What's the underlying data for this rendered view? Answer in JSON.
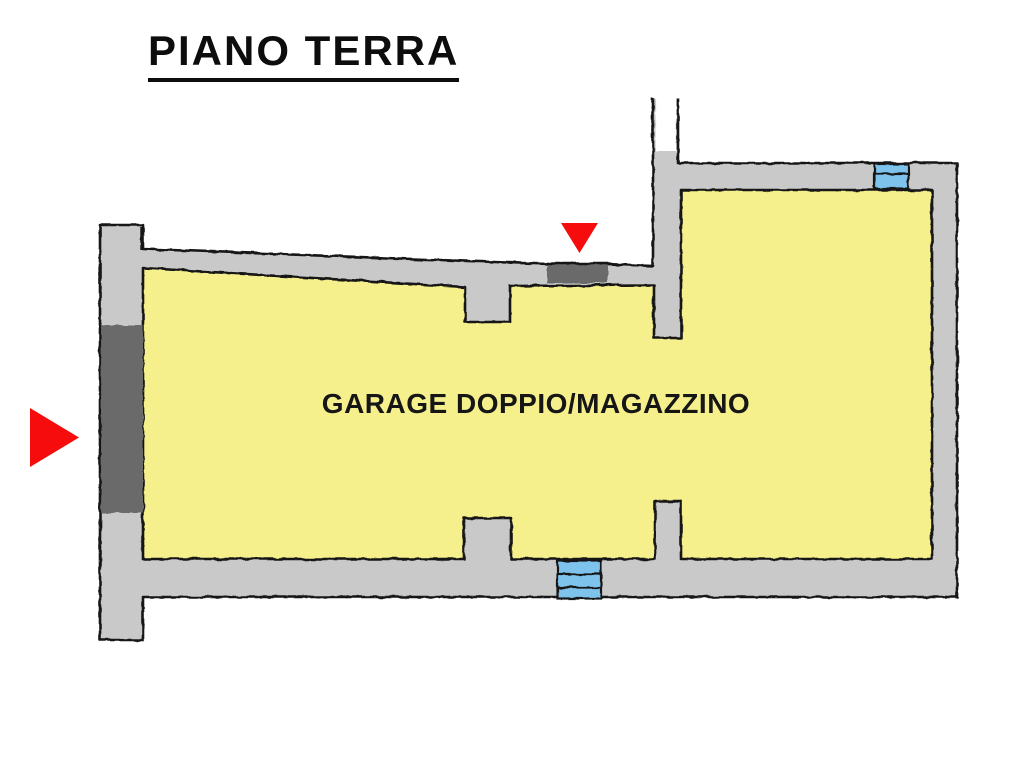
{
  "title": "PIANO TERRA",
  "floor_plan": {
    "room_label": "GARAGE DOPPIO/MAGAZZINO",
    "markers": {
      "side_entrance_icon": "red-arrow-right",
      "top_entrance_icon": "red-arrow-down"
    },
    "features": {
      "windows": 2,
      "door_openings": 2
    }
  },
  "colors": {
    "background": "#ffffff",
    "interior": "#f5f08c",
    "wall": "#c9c9c9",
    "door": "#6b6b6b",
    "window": "#7ec3ec",
    "arrow": "#f60c0c",
    "outline": "#141414"
  }
}
